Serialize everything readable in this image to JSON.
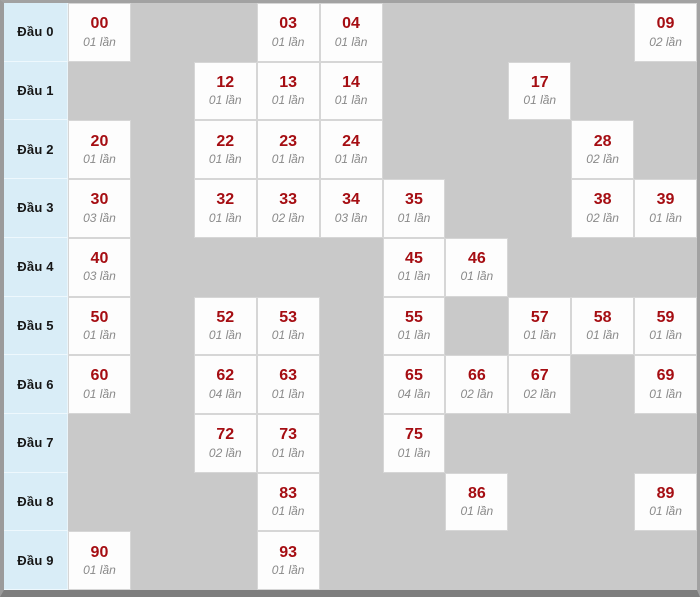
{
  "chart_data": {
    "type": "table",
    "row_label_prefix": "Đầu",
    "unit_word": "lần",
    "columns": [
      0,
      1,
      2,
      3,
      4,
      5,
      6,
      7,
      8,
      9
    ],
    "rows": [
      {
        "label": "Đầu 0",
        "cells": [
          {
            "col": 0,
            "number": "00",
            "count": "01 lần",
            "times": 1
          },
          {
            "col": 3,
            "number": "03",
            "count": "01 lần",
            "times": 1
          },
          {
            "col": 4,
            "number": "04",
            "count": "01 lần",
            "times": 1
          },
          {
            "col": 9,
            "number": "09",
            "count": "02 lần",
            "times": 2
          }
        ]
      },
      {
        "label": "Đầu 1",
        "cells": [
          {
            "col": 2,
            "number": "12",
            "count": "01 lần",
            "times": 1
          },
          {
            "col": 3,
            "number": "13",
            "count": "01 lần",
            "times": 1
          },
          {
            "col": 4,
            "number": "14",
            "count": "01 lần",
            "times": 1
          },
          {
            "col": 7,
            "number": "17",
            "count": "01 lần",
            "times": 1
          }
        ]
      },
      {
        "label": "Đầu 2",
        "cells": [
          {
            "col": 0,
            "number": "20",
            "count": "01 lần",
            "times": 1
          },
          {
            "col": 2,
            "number": "22",
            "count": "01 lần",
            "times": 1
          },
          {
            "col": 3,
            "number": "23",
            "count": "01 lần",
            "times": 1
          },
          {
            "col": 4,
            "number": "24",
            "count": "01 lần",
            "times": 1
          },
          {
            "col": 8,
            "number": "28",
            "count": "02 lần",
            "times": 2
          }
        ]
      },
      {
        "label": "Đầu 3",
        "cells": [
          {
            "col": 0,
            "number": "30",
            "count": "03 lần",
            "times": 3
          },
          {
            "col": 2,
            "number": "32",
            "count": "01 lần",
            "times": 1
          },
          {
            "col": 3,
            "number": "33",
            "count": "02 lần",
            "times": 2
          },
          {
            "col": 4,
            "number": "34",
            "count": "03 lần",
            "times": 3
          },
          {
            "col": 5,
            "number": "35",
            "count": "01 lần",
            "times": 1
          },
          {
            "col": 8,
            "number": "38",
            "count": "02 lần",
            "times": 2
          },
          {
            "col": 9,
            "number": "39",
            "count": "01 lần",
            "times": 1
          }
        ]
      },
      {
        "label": "Đầu 4",
        "cells": [
          {
            "col": 0,
            "number": "40",
            "count": "03 lần",
            "times": 3
          },
          {
            "col": 5,
            "number": "45",
            "count": "01 lần",
            "times": 1
          },
          {
            "col": 6,
            "number": "46",
            "count": "01 lần",
            "times": 1
          }
        ]
      },
      {
        "label": "Đầu 5",
        "cells": [
          {
            "col": 0,
            "number": "50",
            "count": "01 lần",
            "times": 1
          },
          {
            "col": 2,
            "number": "52",
            "count": "01 lần",
            "times": 1
          },
          {
            "col": 3,
            "number": "53",
            "count": "01 lần",
            "times": 1
          },
          {
            "col": 5,
            "number": "55",
            "count": "01 lần",
            "times": 1
          },
          {
            "col": 7,
            "number": "57",
            "count": "01 lần",
            "times": 1
          },
          {
            "col": 8,
            "number": "58",
            "count": "01 lần",
            "times": 1
          },
          {
            "col": 9,
            "number": "59",
            "count": "01 lần",
            "times": 1
          }
        ]
      },
      {
        "label": "Đầu 6",
        "cells": [
          {
            "col": 0,
            "number": "60",
            "count": "01 lần",
            "times": 1
          },
          {
            "col": 2,
            "number": "62",
            "count": "04 lần",
            "times": 4
          },
          {
            "col": 3,
            "number": "63",
            "count": "01 lần",
            "times": 1
          },
          {
            "col": 5,
            "number": "65",
            "count": "04 lần",
            "times": 4
          },
          {
            "col": 6,
            "number": "66",
            "count": "02 lần",
            "times": 2
          },
          {
            "col": 7,
            "number": "67",
            "count": "02 lần",
            "times": 2
          },
          {
            "col": 9,
            "number": "69",
            "count": "01 lần",
            "times": 1
          }
        ]
      },
      {
        "label": "Đầu 7",
        "cells": [
          {
            "col": 2,
            "number": "72",
            "count": "02 lần",
            "times": 2
          },
          {
            "col": 3,
            "number": "73",
            "count": "01 lần",
            "times": 1
          },
          {
            "col": 5,
            "number": "75",
            "count": "01 lần",
            "times": 1
          }
        ]
      },
      {
        "label": "Đầu 8",
        "cells": [
          {
            "col": 3,
            "number": "83",
            "count": "01 lần",
            "times": 1
          },
          {
            "col": 6,
            "number": "86",
            "count": "01 lần",
            "times": 1
          },
          {
            "col": 9,
            "number": "89",
            "count": "01 lần",
            "times": 1
          }
        ]
      },
      {
        "label": "Đầu 9",
        "cells": [
          {
            "col": 0,
            "number": "90",
            "count": "01 lần",
            "times": 1
          },
          {
            "col": 3,
            "number": "93",
            "count": "01 lần",
            "times": 1
          }
        ]
      }
    ]
  },
  "colors": {
    "number_red": "#a50d12",
    "count_gray": "#8a8a8a",
    "label_bg": "#d9edf7",
    "empty_bg": "#c9c9c9",
    "filled_bg": "#fdfdfd",
    "frame_gray": "#9b9b9b"
  }
}
